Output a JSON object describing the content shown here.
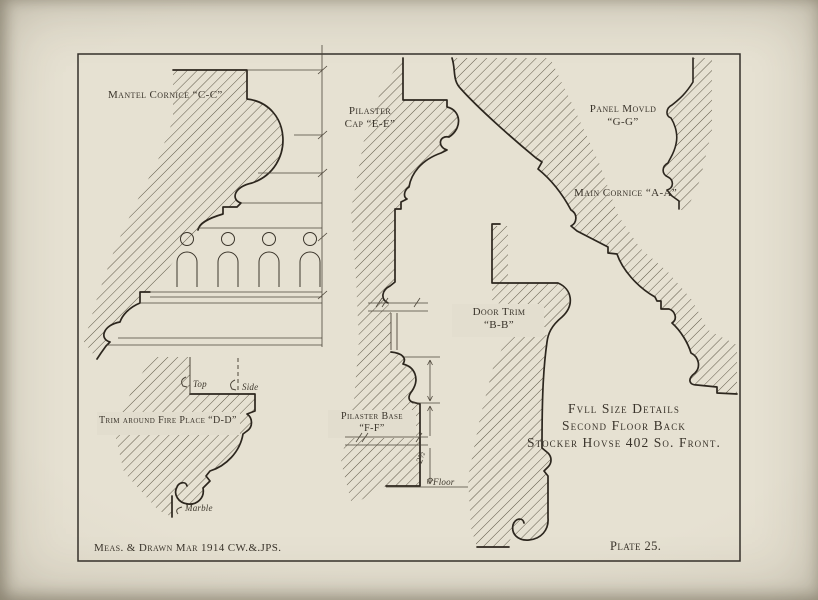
{
  "colors": {
    "paper": "#e3decf",
    "paper_edge": "#c9c2b0",
    "ink": "#2c261e",
    "thin_line": "#4d463a"
  },
  "labels": {
    "mantel_cornice": "Mantel Cornice “C-C”",
    "pilaster_cap_line1": "Pilaster",
    "pilaster_cap_line2": "Cap “E-E”",
    "panel_mould_line1": "Panel Movld",
    "panel_mould_line2": "“G-G”",
    "main_cornice": "Main Cornice “A-A”",
    "door_trim_line1": "Door Trim",
    "door_trim_line2": "“B-B”",
    "fireplace_trim": "Trim around Fire Place “D-D”",
    "pilaster_base_line1": "Pilaster Base",
    "pilaster_base_line2": "“F-F”"
  },
  "title_block": {
    "line1": "Fvll Size Details",
    "line2": "Second Floor Back",
    "line3": "Stocker Hovse 402 So. Front."
  },
  "footer": {
    "credit": "Meas. & Drawn Mar 1914 CW.&.JPS.",
    "plate_number": "Plate 25."
  },
  "annotations": {
    "top": "Top",
    "side": "Side",
    "marble": "Marble",
    "floor": "Floor",
    "dimension": "2½"
  }
}
